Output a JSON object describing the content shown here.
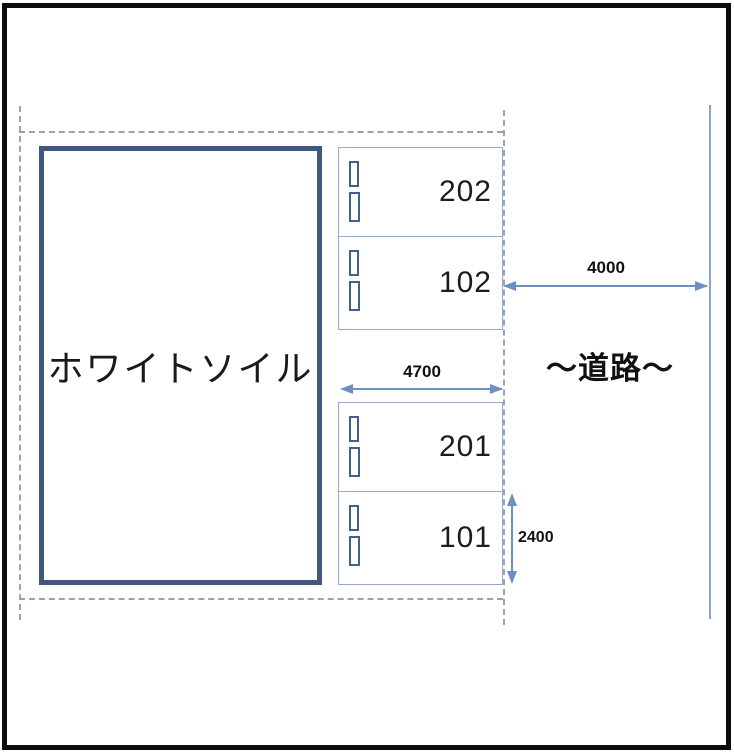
{
  "building": {
    "label": "ホワイトソイル"
  },
  "units": [
    {
      "id": "202"
    },
    {
      "id": "102"
    },
    {
      "id": "201"
    },
    {
      "id": "101"
    }
  ],
  "dimensions": {
    "road_width": "4000",
    "parking_frontage": "4700",
    "parking_depth": "2400"
  },
  "road": {
    "label": "～道路～"
  },
  "colors": {
    "frame": "#0c0c0c",
    "building_border": "#40587c",
    "unit_border": "#96abc9",
    "marker_border": "#44608c",
    "dimension_arrow": "#6e90c0",
    "boundary_dash": "#97a4b3",
    "road_line": "#86a7cd",
    "text": "#1c1c1c"
  }
}
